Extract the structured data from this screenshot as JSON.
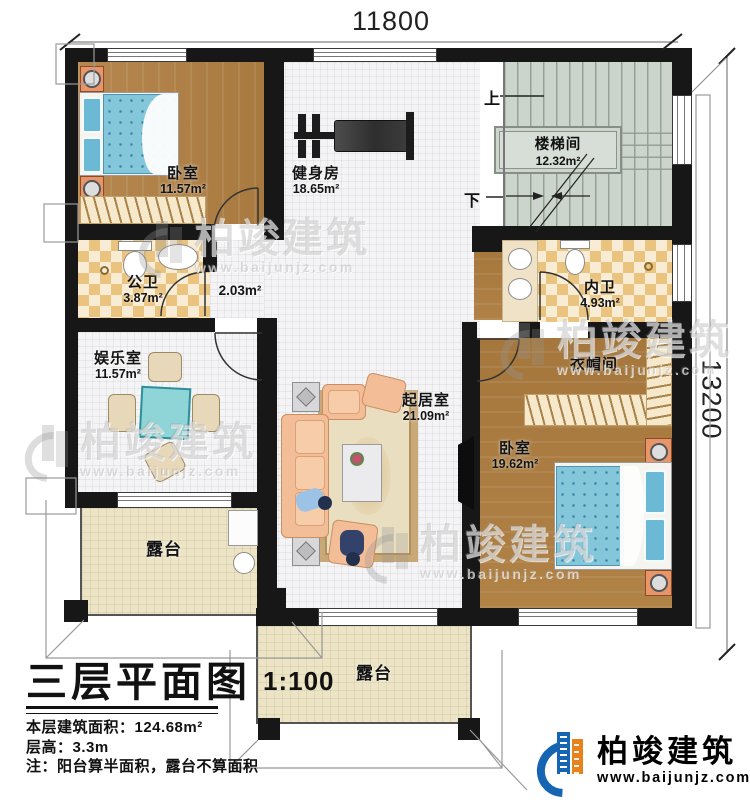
{
  "dimensions": {
    "width_mm": "11800",
    "height_mm": "13200"
  },
  "stairwell_marks": {
    "up": "上",
    "down": "下"
  },
  "rooms": {
    "bedroom1": {
      "name": "卧室",
      "area": "11.57m²"
    },
    "gym": {
      "name": "健身房",
      "area": "18.65m²"
    },
    "stairwell": {
      "name": "楼梯间",
      "area": "12.32m²"
    },
    "public_bath": {
      "name": "公卫",
      "area": "3.87m²"
    },
    "hallway": {
      "area": "2.03m²"
    },
    "ensuite_bath": {
      "name": "内卫",
      "area": "4.93m²"
    },
    "recreation": {
      "name": "娱乐室",
      "area": "11.57m²"
    },
    "living": {
      "name": "起居室",
      "area": "21.09m²"
    },
    "cloakroom": {
      "name": "衣帽间"
    },
    "bedroom2": {
      "name": "卧室",
      "area": "19.62m²"
    },
    "terrace_left": {
      "name": "露台"
    },
    "terrace_bottom": {
      "name": "露台"
    }
  },
  "title_block": {
    "title": "三层平面图",
    "scale": "1:100",
    "building_area": "本层建筑面积：124.68m²",
    "floor_height": "层高：3.3m",
    "note": "注：阳台算半面积，露台不算面积"
  },
  "brand": {
    "name": "柏竣建筑",
    "website": "www.baijunjz.com"
  },
  "watermark": {
    "name": "柏竣建筑",
    "website": "www.baijunjz.com"
  }
}
